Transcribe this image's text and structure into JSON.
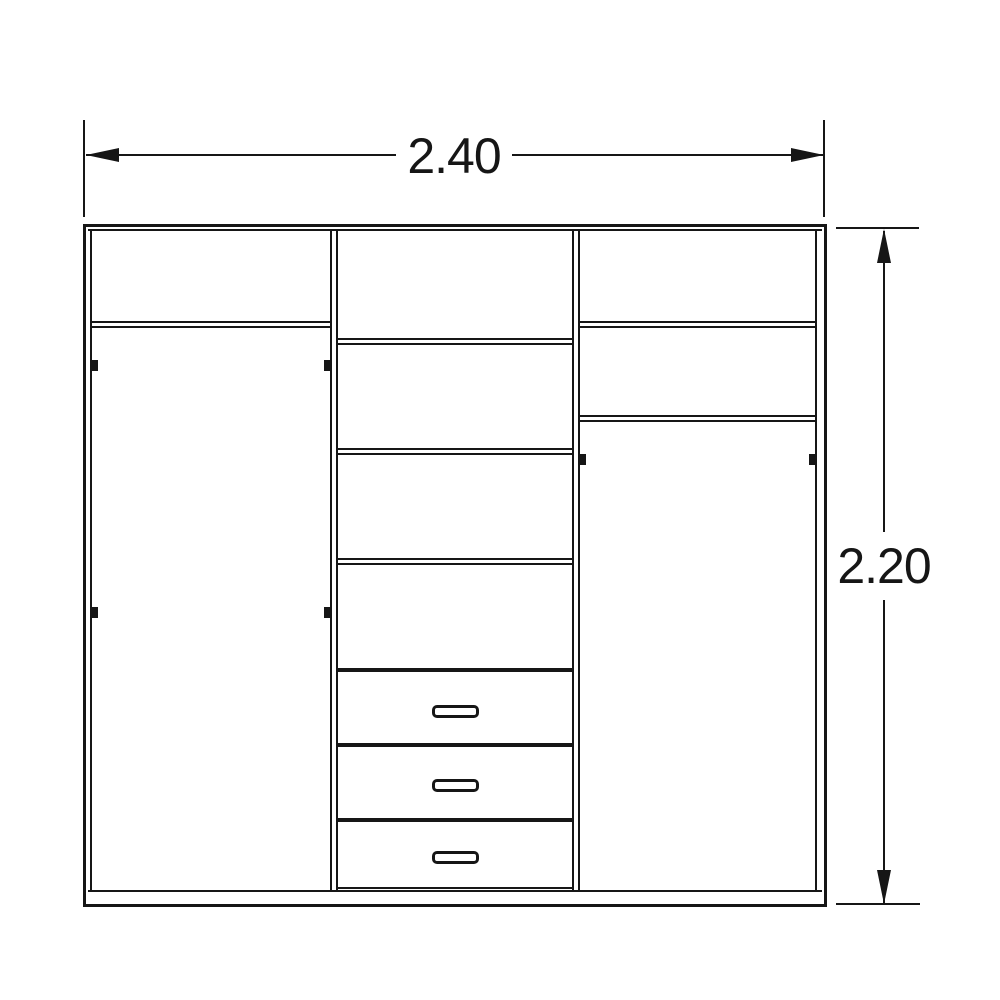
{
  "drawing": {
    "type": "wardrobe-front-elevation-technical-drawing",
    "line_color": "#161616",
    "background_color": "#ffffff",
    "width_dimension": {
      "label": "2.40"
    },
    "height_dimension": {
      "label": "2.20"
    },
    "structure": {
      "sections": [
        {
          "name": "left",
          "features": [
            "top compartment",
            "shelf",
            "hanging rod",
            "hanging rod"
          ]
        },
        {
          "name": "middle",
          "features": [
            "4 shelf compartments",
            "3 drawers with handles"
          ]
        },
        {
          "name": "right",
          "features": [
            "top compartment",
            "shelf",
            "shelf",
            "hanging rod"
          ]
        }
      ],
      "drawer_count": 3
    }
  }
}
